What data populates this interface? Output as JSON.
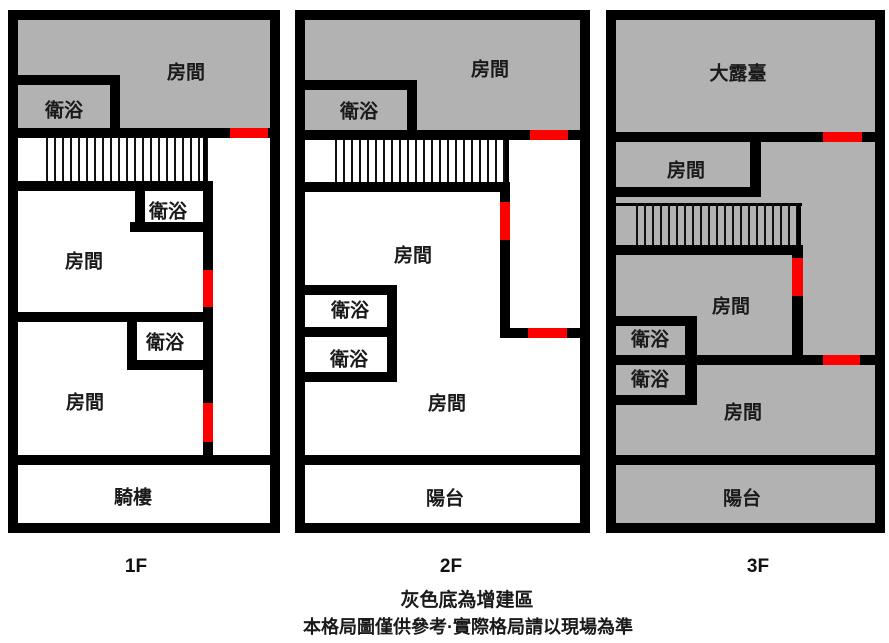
{
  "colors": {
    "wall_black": "#000000",
    "addition_gray": "#b2b2b2",
    "door_red": "#ff0000",
    "background": "#ffffff"
  },
  "floors": [
    {
      "floor_label": "1F",
      "rooms": {
        "top_room": "房間",
        "top_bath": "衛浴",
        "mid_bath": "衛浴",
        "mid_room": "房間",
        "low_bath": "衛浴",
        "low_room": "房間",
        "base": "騎樓"
      }
    },
    {
      "floor_label": "2F",
      "rooms": {
        "top_room": "房間",
        "top_bath": "衛浴",
        "mid_room": "房間",
        "bath1": "衛浴",
        "bath2": "衛浴",
        "low_room": "房間",
        "base": "陽台"
      }
    },
    {
      "floor_label": "3F",
      "rooms": {
        "terrace": "大露臺",
        "upper_room": "房間",
        "mid_room": "房間",
        "bath1": "衛浴",
        "bath2": "衛浴",
        "low_room": "房間",
        "base": "陽台"
      }
    }
  ],
  "notes": {
    "legend": "灰色底為增建區",
    "disclaimer": "本格局圖僅供參考·實際格局請以現場為準"
  }
}
